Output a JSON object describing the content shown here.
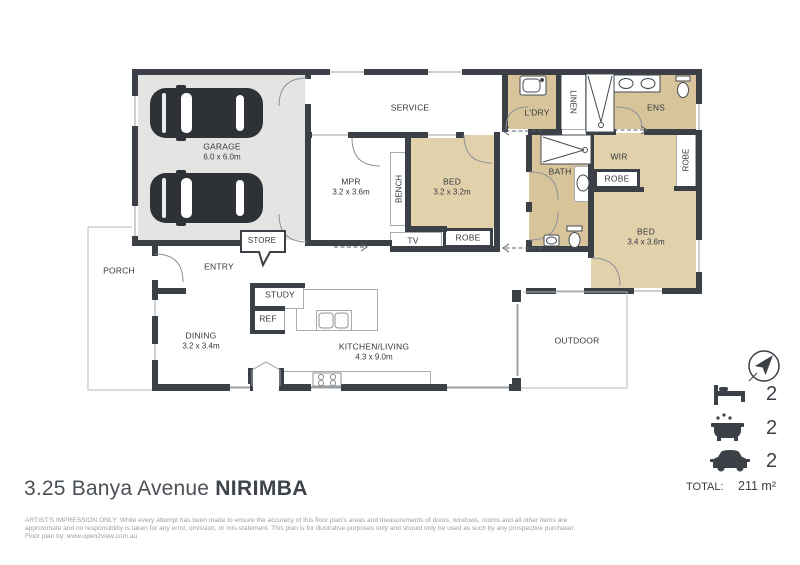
{
  "title": {
    "address": "3.25 Banya Avenue",
    "suburb": "NIRIMBA"
  },
  "plan": {
    "rooms": {
      "garage": {
        "name": "GARAGE",
        "dim": "6.0 x 6.0m"
      },
      "service": {
        "name": "SERVICE"
      },
      "mpr": {
        "name": "MPR",
        "dim": "3.2 x 3.6m"
      },
      "bed1": {
        "name": "BED",
        "dim": "3.2 x 3.2m"
      },
      "ldry": {
        "name": "L'DRY"
      },
      "linen": {
        "name": "LINEN"
      },
      "ens": {
        "name": "ENS"
      },
      "bath": {
        "name": "BATH"
      },
      "wir": {
        "name": "WIR"
      },
      "bed2": {
        "name": "BED",
        "dim": "3.4 x 3.6m"
      },
      "porch": {
        "name": "PORCH"
      },
      "entry": {
        "name": "ENTRY"
      },
      "dining": {
        "name": "DINING",
        "dim": "3.2 x 3.4m"
      },
      "kitchen_living": {
        "name": "KITCHEN/LIVING",
        "dim": "4.3 x 9.0m"
      },
      "outdoor": {
        "name": "OUTDOOR"
      }
    },
    "fixtures": {
      "store": "STORE",
      "bench": "BENCH",
      "tv": "TV",
      "robe_bed1": "ROBE",
      "robe_wir": "ROBE",
      "robe_bed2": "ROBE",
      "study": "STUDY",
      "ref": "REF"
    }
  },
  "legend": {
    "bedrooms": "2",
    "bathrooms": "2",
    "car_spaces": "2",
    "total_label": "TOTAL:",
    "total_value": "211 m²"
  },
  "footer": {
    "disclaimer_line1": "ARTIST'S IMPRESSION ONLY: While every attempt has been made to ensure the accuracy of this floor plan's areas and measurements of doors, windows, rooms and all other items are",
    "disclaimer_line2": "approximate and no responsibility is taken for any error, omission, or mis-statement. This plan is for illustrative purposes only and should only be used as such by any prospective purchaser.",
    "credit": "Floor plan by: www.open2view.com.au"
  },
  "colors": {
    "wall": "#3b4046",
    "room_tan": "#e2d2ac",
    "wet_tan": "#d7c49a",
    "garage_gray": "#e4e4e3",
    "fixture_dark": "#2e3237",
    "text_dark": "#3c4147",
    "text_muted": "#9aa0a5"
  }
}
